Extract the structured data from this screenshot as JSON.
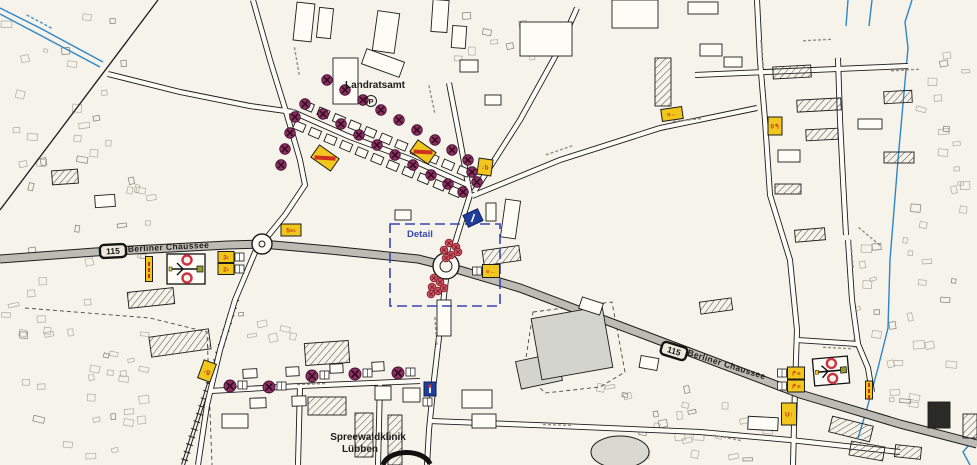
{
  "labels": {
    "landratsamt": "Landratsamt",
    "parking_symbol": "P",
    "detail": "Detail",
    "berliner_left": "Berliner Chaussee",
    "berliner_right": "Berliner Chaussee",
    "clinic_line1": "Spreewaldklinik",
    "clinic_line2": "Lübben"
  },
  "route_badges": [
    {
      "number": "115",
      "cx": 113,
      "cy": 251,
      "rot": -3
    },
    {
      "number": "115",
      "cx": 674,
      "cy": 351,
      "rot": 17
    }
  ],
  "colors": {
    "paper": "#f6f3ea",
    "street_fill": "#fdfcf6",
    "main_road": "#bcbcb5",
    "ink": "#1c1c1a",
    "water": "#2e86c8",
    "marker_purple": "#8e2f63",
    "signal_red": "#cf5663",
    "sign_yellow": "#f2c71d",
    "sign_red": "#c23415",
    "sign_blue": "#1e3f9e",
    "detail_blue": "#3646b4"
  },
  "symbols": {
    "roundabouts": [
      {
        "cx": 262,
        "cy": 244,
        "r": 10
      },
      {
        "cx": 446,
        "cy": 266,
        "r": 13
      }
    ],
    "signal_markers": [
      [
        327,
        80
      ],
      [
        345,
        90
      ],
      [
        363,
        100
      ],
      [
        381,
        110
      ],
      [
        399,
        120
      ],
      [
        417,
        130
      ],
      [
        435,
        140
      ],
      [
        452,
        150
      ],
      [
        468,
        160
      ],
      [
        305,
        104
      ],
      [
        323,
        114
      ],
      [
        341,
        124
      ],
      [
        359,
        135
      ],
      [
        377,
        145
      ],
      [
        395,
        155
      ],
      [
        413,
        165
      ],
      [
        431,
        175
      ],
      [
        448,
        184
      ],
      [
        463,
        192
      ],
      [
        295,
        117
      ],
      [
        290,
        133
      ],
      [
        285,
        149
      ],
      [
        281,
        165
      ],
      [
        472,
        172
      ],
      [
        477,
        182
      ]
    ],
    "signal_markers_boxed": [
      [
        230,
        386
      ],
      [
        269,
        387
      ],
      [
        312,
        376
      ],
      [
        355,
        374
      ],
      [
        398,
        373
      ]
    ],
    "signal_clusters": [
      [
        449,
        243
      ],
      [
        456,
        247
      ],
      [
        444,
        250
      ],
      [
        451,
        255
      ],
      [
        458,
        252
      ],
      [
        446,
        258
      ],
      [
        434,
        278
      ],
      [
        440,
        282
      ],
      [
        432,
        287
      ],
      [
        438,
        291
      ],
      [
        444,
        288
      ],
      [
        431,
        294
      ]
    ],
    "signs": [
      {
        "cx": 325,
        "cy": 158,
        "w": 24,
        "h": 15,
        "rot": 35,
        "type": "warning"
      },
      {
        "cx": 423,
        "cy": 152,
        "w": 22,
        "h": 14,
        "rot": 35,
        "type": "warning"
      },
      {
        "cx": 485,
        "cy": 167,
        "w": 14,
        "h": 16,
        "rot": 8,
        "glyph": "↓b"
      },
      {
        "cx": 226,
        "cy": 257,
        "w": 16,
        "h": 11,
        "rot": 0,
        "glyph": "3‹",
        "box": "right"
      },
      {
        "cx": 226,
        "cy": 269,
        "w": 16,
        "h": 11,
        "rot": 0,
        "glyph": "2‹",
        "box": "right"
      },
      {
        "cx": 291,
        "cy": 230,
        "w": 20,
        "h": 12,
        "rot": 0,
        "glyph": "5≡‹"
      },
      {
        "cx": 491,
        "cy": 271,
        "w": 17,
        "h": 13,
        "rot": 0,
        "glyph": "≡←",
        "box": "left"
      },
      {
        "cx": 149,
        "cy": 269,
        "w": 7,
        "h": 25,
        "rot": 0,
        "type": "vtext"
      },
      {
        "cx": 672,
        "cy": 114,
        "w": 21,
        "h": 12,
        "rot": -8,
        "glyph": "≡←"
      },
      {
        "cx": 775,
        "cy": 126,
        "w": 14,
        "h": 18,
        "rot": 0,
        "glyph": "0↰"
      },
      {
        "cx": 796,
        "cy": 373,
        "w": 17,
        "h": 12,
        "rot": 0,
        "glyph": "↱≡",
        "box": "left"
      },
      {
        "cx": 796,
        "cy": 386,
        "w": 17,
        "h": 12,
        "rot": 0,
        "glyph": "↱≡",
        "box": "left"
      },
      {
        "cx": 789,
        "cy": 414,
        "w": 15,
        "h": 22,
        "rot": 0,
        "glyph": "U↑"
      },
      {
        "cx": 869,
        "cy": 390,
        "w": 7,
        "h": 18,
        "rot": 0,
        "type": "vtext"
      },
      {
        "cx": 207,
        "cy": 371,
        "w": 13,
        "h": 19,
        "rot": 20,
        "glyph": "↓g"
      }
    ],
    "schematic_boxes": [
      {
        "cx": 186,
        "cy": 269,
        "w": 38,
        "h": 30,
        "rot": 0
      },
      {
        "cx": 831,
        "cy": 371,
        "w": 35,
        "h": 27,
        "rot": -5
      }
    ],
    "blue_signs": [
      {
        "cx": 473,
        "cy": 218,
        "w": 16,
        "h": 13,
        "rot": -25,
        "kind": "parking"
      },
      {
        "cx": 430,
        "cy": 389,
        "w": 12,
        "h": 14,
        "rot": 0,
        "kind": "info"
      }
    ],
    "detail_box": {
      "x": 390,
      "y": 224,
      "w": 110,
      "h": 82
    }
  }
}
